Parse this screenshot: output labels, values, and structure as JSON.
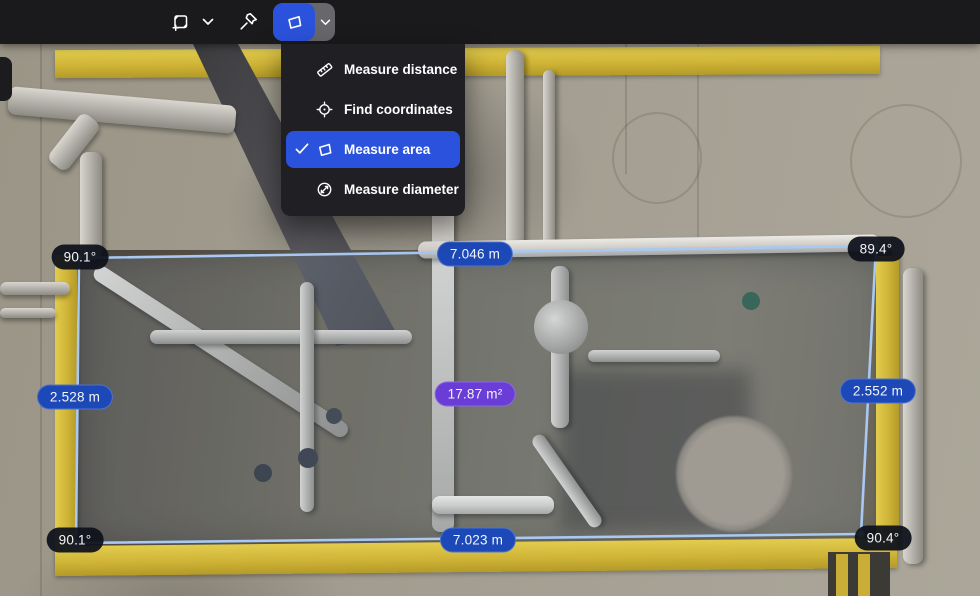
{
  "toolbar": {
    "tools": [
      {
        "id": "crop-box-tool",
        "icon": "cube-plus-icon"
      },
      {
        "id": "crop-box-expand",
        "icon": "chevron-down-icon"
      },
      {
        "id": "pin-tool",
        "icon": "pin-icon"
      },
      {
        "id": "measure-area-tool",
        "icon": "polygon-icon",
        "active": true
      },
      {
        "id": "measure-tool-expand",
        "icon": "chevron-down-icon"
      }
    ]
  },
  "measure_menu": {
    "items": [
      {
        "label": "Measure distance",
        "icon": "ruler-icon",
        "selected": false
      },
      {
        "label": "Find coordinates",
        "icon": "crosshair-icon",
        "selected": false
      },
      {
        "label": "Measure area",
        "icon": "polygon-icon",
        "selected": true
      },
      {
        "label": "Measure diameter",
        "icon": "diameter-icon",
        "selected": false
      }
    ]
  },
  "measurement": {
    "type": "area",
    "area": {
      "text": "17.87 m²",
      "value": 17.87,
      "unit": "m²"
    },
    "edges": {
      "top": {
        "text": "7.046 m",
        "value": 7.046,
        "unit": "m"
      },
      "bottom": {
        "text": "7.023 m",
        "value": 7.023,
        "unit": "m"
      },
      "left": {
        "text": "2.528 m",
        "value": 2.528,
        "unit": "m"
      },
      "right": {
        "text": "2.552 m",
        "value": 2.552,
        "unit": "m"
      }
    },
    "angles": {
      "top_left": {
        "text": "90.1°",
        "value": 90.1
      },
      "top_right": {
        "text": "89.4°",
        "value": 89.4
      },
      "bottom_left": {
        "text": "90.1°",
        "value": 90.1
      },
      "bottom_right": {
        "text": "90.4°",
        "value": 90.4
      }
    }
  },
  "colors": {
    "accent_blue": "#2b52dc",
    "distance_pill": "#1d49b8",
    "area_pill": "#6a3ed6",
    "angle_pill": "#10131c",
    "polygon_stroke": "#a9c8f2",
    "toolbar_bg": "#1a1a1c",
    "menu_bg": "#202024"
  }
}
